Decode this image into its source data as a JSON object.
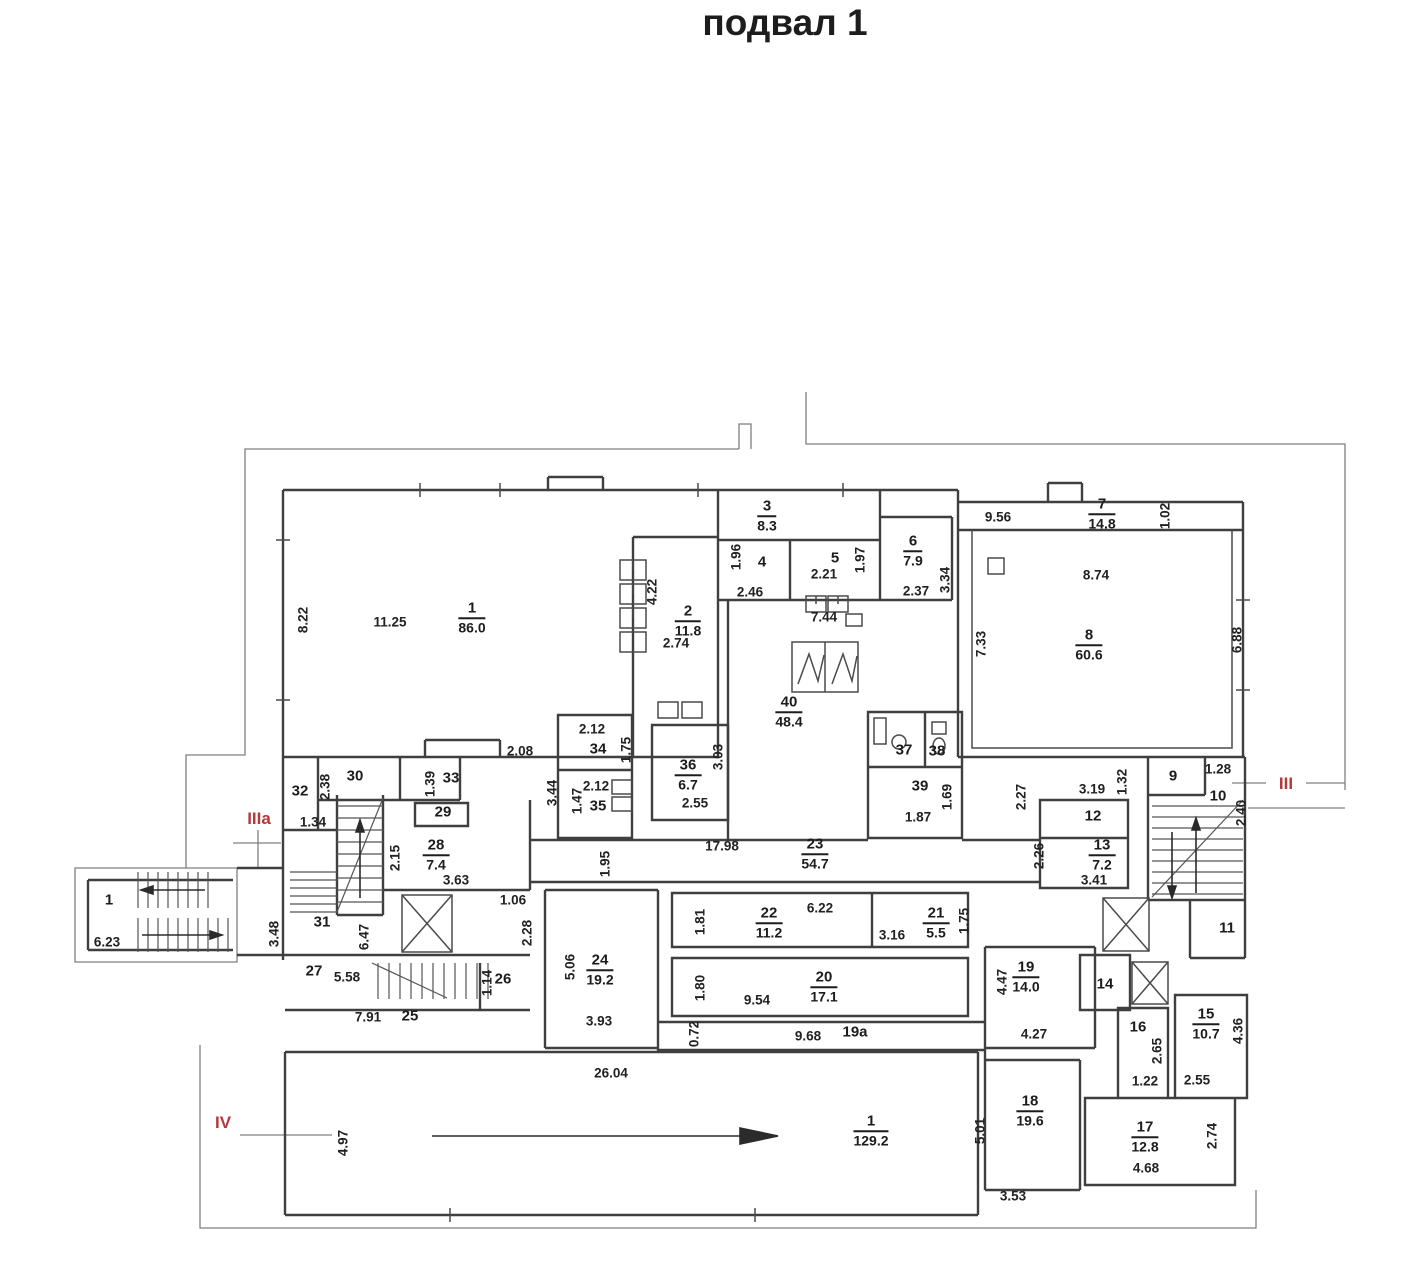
{
  "title": "подвал 1",
  "plan": {
    "rooms": [
      {
        "num": "1",
        "area": "86.0",
        "x": 472,
        "y": 618
      },
      {
        "num": "2",
        "area": "11.8",
        "x": 688,
        "y": 621
      },
      {
        "num": "3",
        "area": "8.3",
        "x": 767,
        "y": 516
      },
      {
        "num": "6",
        "area": "7.9",
        "x": 913,
        "y": 551
      },
      {
        "num": "7",
        "area": "14.8",
        "x": 1102,
        "y": 514
      },
      {
        "num": "8",
        "area": "60.6",
        "x": 1089,
        "y": 645
      },
      {
        "num": "40",
        "area": "48.4",
        "x": 789,
        "y": 712
      },
      {
        "num": "36",
        "area": "6.7",
        "x": 688,
        "y": 775
      },
      {
        "num": "23",
        "area": "54.7",
        "x": 815,
        "y": 854
      },
      {
        "num": "28",
        "area": "7.4",
        "x": 436,
        "y": 855
      },
      {
        "num": "13",
        "area": "7.2",
        "x": 1102,
        "y": 855
      },
      {
        "num": "24",
        "area": "19.2",
        "x": 600,
        "y": 970
      },
      {
        "num": "22",
        "area": "11.2",
        "x": 769,
        "y": 923
      },
      {
        "num": "20",
        "area": "17.1",
        "x": 824,
        "y": 987
      },
      {
        "num": "21",
        "area": "5.5",
        "x": 936,
        "y": 923
      },
      {
        "num": "19",
        "area": "14.0",
        "x": 1026,
        "y": 977
      },
      {
        "num": "15",
        "area": "10.7",
        "x": 1206,
        "y": 1024
      },
      {
        "num": "18",
        "area": "19.6",
        "x": 1030,
        "y": 1111
      },
      {
        "num": "17",
        "area": "12.8",
        "x": 1145,
        "y": 1137
      },
      {
        "num": "1",
        "area": "129.2",
        "x": 871,
        "y": 1131
      }
    ],
    "numbers": [
      {
        "t": "4",
        "x": 762,
        "y": 562
      },
      {
        "t": "5",
        "x": 835,
        "y": 558
      },
      {
        "t": "30",
        "x": 355,
        "y": 776
      },
      {
        "t": "32",
        "x": 300,
        "y": 791
      },
      {
        "t": "33",
        "x": 451,
        "y": 778
      },
      {
        "t": "29",
        "x": 443,
        "y": 812
      },
      {
        "t": "31",
        "x": 322,
        "y": 922
      },
      {
        "t": "27",
        "x": 314,
        "y": 971
      },
      {
        "t": "25",
        "x": 410,
        "y": 1016
      },
      {
        "t": "26",
        "x": 503,
        "y": 979
      },
      {
        "t": "34",
        "x": 598,
        "y": 749
      },
      {
        "t": "35",
        "x": 598,
        "y": 806
      },
      {
        "t": "37",
        "x": 904,
        "y": 750
      },
      {
        "t": "38",
        "x": 937,
        "y": 751
      },
      {
        "t": "39",
        "x": 920,
        "y": 786
      },
      {
        "t": "9",
        "x": 1173,
        "y": 776
      },
      {
        "t": "10",
        "x": 1218,
        "y": 796
      },
      {
        "t": "11",
        "x": 1227,
        "y": 928
      },
      {
        "t": "12",
        "x": 1093,
        "y": 816
      },
      {
        "t": "14",
        "x": 1105,
        "y": 984
      },
      {
        "t": "16",
        "x": 1138,
        "y": 1027
      },
      {
        "t": "1",
        "x": 109,
        "y": 900
      },
      {
        "t": "19а",
        "x": 855,
        "y": 1032
      }
    ],
    "dims": [
      {
        "t": "8.22",
        "x": 303,
        "y": 620,
        "v": 1
      },
      {
        "t": "11.25",
        "x": 390,
        "y": 622
      },
      {
        "t": "4.22",
        "x": 652,
        "y": 592,
        "v": 1
      },
      {
        "t": "2.74",
        "x": 676,
        "y": 643
      },
      {
        "t": "1.96",
        "x": 736,
        "y": 557,
        "v": 1
      },
      {
        "t": "2.46",
        "x": 750,
        "y": 592
      },
      {
        "t": "2.21",
        "x": 824,
        "y": 574
      },
      {
        "t": "1.97",
        "x": 860,
        "y": 560,
        "v": 1
      },
      {
        "t": "7.44",
        "x": 824,
        "y": 617
      },
      {
        "t": "2.37",
        "x": 916,
        "y": 591
      },
      {
        "t": "3.34",
        "x": 945,
        "y": 580,
        "v": 1
      },
      {
        "t": "9.56",
        "x": 998,
        "y": 517
      },
      {
        "t": "1.02",
        "x": 1165,
        "y": 516,
        "v": 1
      },
      {
        "t": "8.74",
        "x": 1096,
        "y": 575
      },
      {
        "t": "7.33",
        "x": 981,
        "y": 644,
        "v": 1
      },
      {
        "t": "6.88",
        "x": 1237,
        "y": 640,
        "v": 1
      },
      {
        "t": "2.08",
        "x": 520,
        "y": 751
      },
      {
        "t": "2.12",
        "x": 592,
        "y": 729
      },
      {
        "t": "1.75",
        "x": 626,
        "y": 750,
        "v": 1
      },
      {
        "t": "2.12",
        "x": 596,
        "y": 786
      },
      {
        "t": "1.47",
        "x": 577,
        "y": 801,
        "v": 1
      },
      {
        "t": "3.44",
        "x": 552,
        "y": 793,
        "v": 1
      },
      {
        "t": "2.55",
        "x": 695,
        "y": 803
      },
      {
        "t": "3.03",
        "x": 718,
        "y": 757,
        "v": 1
      },
      {
        "t": "17.98",
        "x": 722,
        "y": 846
      },
      {
        "t": "1.95",
        "x": 605,
        "y": 864,
        "v": 1
      },
      {
        "t": "2.38",
        "x": 325,
        "y": 787,
        "v": 1
      },
      {
        "t": "1.34",
        "x": 313,
        "y": 822
      },
      {
        "t": "1.39",
        "x": 430,
        "y": 784,
        "v": 1
      },
      {
        "t": "2.15",
        "x": 395,
        "y": 858,
        "v": 1
      },
      {
        "t": "3.63",
        "x": 456,
        "y": 880
      },
      {
        "t": "1.06",
        "x": 513,
        "y": 900
      },
      {
        "t": "2.28",
        "x": 527,
        "y": 933,
        "v": 1
      },
      {
        "t": "3.48",
        "x": 274,
        "y": 934,
        "v": 1
      },
      {
        "t": "6.47",
        "x": 364,
        "y": 937,
        "v": 1
      },
      {
        "t": "5.58",
        "x": 347,
        "y": 977
      },
      {
        "t": "7.91",
        "x": 368,
        "y": 1017
      },
      {
        "t": "1.14",
        "x": 487,
        "y": 983,
        "v": 1
      },
      {
        "t": "26.04",
        "x": 611,
        "y": 1073
      },
      {
        "t": "5.06",
        "x": 570,
        "y": 967,
        "v": 1
      },
      {
        "t": "3.93",
        "x": 599,
        "y": 1021
      },
      {
        "t": "1.81",
        "x": 700,
        "y": 922,
        "v": 1
      },
      {
        "t": "6.22",
        "x": 820,
        "y": 908
      },
      {
        "t": "1.80",
        "x": 700,
        "y": 988,
        "v": 1
      },
      {
        "t": "9.54",
        "x": 757,
        "y": 1000
      },
      {
        "t": "0.72",
        "x": 694,
        "y": 1034,
        "v": 1
      },
      {
        "t": "9.68",
        "x": 808,
        "y": 1036
      },
      {
        "t": "3.16",
        "x": 892,
        "y": 935
      },
      {
        "t": "1.75",
        "x": 964,
        "y": 921,
        "v": 1
      },
      {
        "t": "4.47",
        "x": 1002,
        "y": 982,
        "v": 1
      },
      {
        "t": "4.27",
        "x": 1034,
        "y": 1034
      },
      {
        "t": "2.27",
        "x": 1021,
        "y": 797,
        "v": 1
      },
      {
        "t": "3.19",
        "x": 1092,
        "y": 789
      },
      {
        "t": "1.32",
        "x": 1122,
        "y": 782,
        "v": 1
      },
      {
        "t": "2.26",
        "x": 1039,
        "y": 856,
        "v": 1
      },
      {
        "t": "3.41",
        "x": 1094,
        "y": 880
      },
      {
        "t": "1.69",
        "x": 947,
        "y": 797,
        "v": 1
      },
      {
        "t": "1.87",
        "x": 918,
        "y": 817
      },
      {
        "t": "1.28",
        "x": 1218,
        "y": 769
      },
      {
        "t": "2.40",
        "x": 1241,
        "y": 813,
        "v": 1
      },
      {
        "t": "2.65",
        "x": 1157,
        "y": 1051,
        "v": 1
      },
      {
        "t": "1.22",
        "x": 1145,
        "y": 1081
      },
      {
        "t": "4.36",
        "x": 1238,
        "y": 1031,
        "v": 1
      },
      {
        "t": "2.55",
        "x": 1197,
        "y": 1080
      },
      {
        "t": "4.97",
        "x": 343,
        "y": 1143,
        "v": 1
      },
      {
        "t": "5.01",
        "x": 980,
        "y": 1131,
        "v": 1
      },
      {
        "t": "3.53",
        "x": 1013,
        "y": 1196
      },
      {
        "t": "4.68",
        "x": 1146,
        "y": 1168
      },
      {
        "t": "2.74",
        "x": 1212,
        "y": 1136,
        "v": 1
      },
      {
        "t": "6.23",
        "x": 107,
        "y": 942
      }
    ],
    "sections": [
      {
        "t": "IIIa",
        "x": 259,
        "y": 819
      },
      {
        "t": "III",
        "x": 1286,
        "y": 784
      },
      {
        "t": "IV",
        "x": 223,
        "y": 1123
      }
    ]
  }
}
